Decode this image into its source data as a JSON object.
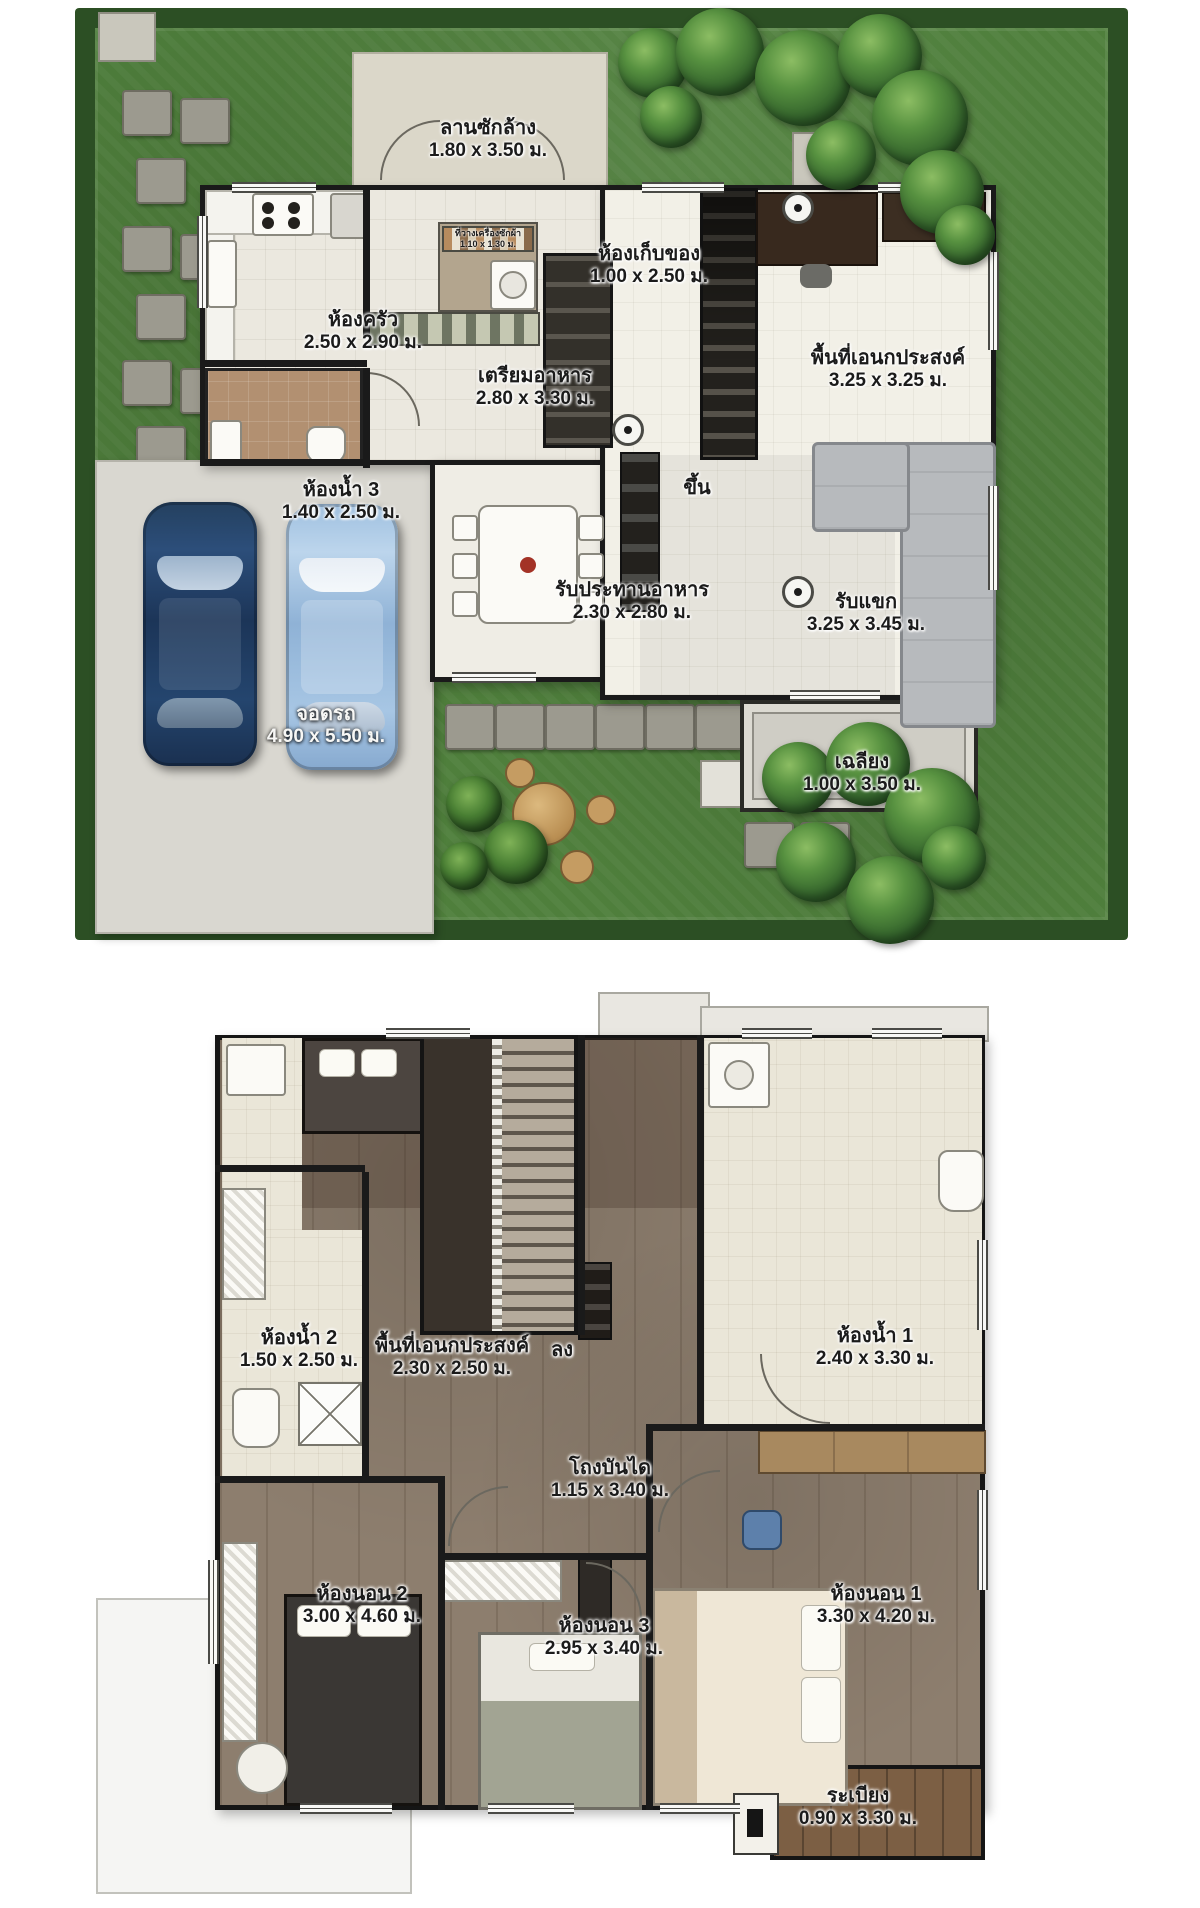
{
  "colors": {
    "grass": "#4f7f3c",
    "hedge": "#2c4f24",
    "floor_cream": "#ebe8df",
    "garage_concrete": "#d9d7d0",
    "wood_floor": "#8d7e6e",
    "balcony_wood": "#7c5f44",
    "bathroom_tile": "#b29071",
    "car_dark_blue": "#2c4e7a",
    "car_light_blue": "#9fc0e0",
    "wall": "#1a1a1a"
  },
  "floor1": {
    "wash_yard": {
      "name": "ลานซักล้าง",
      "dims": "1.80 x 3.50 ม."
    },
    "kitchen": {
      "name": "ห้องครัว",
      "dims": "2.50 x 2.90 ม."
    },
    "laundry": {
      "name": "ที่วางเครื่องซักผ้า",
      "dims": "1.10 x 1.30 ม."
    },
    "storage": {
      "name": "ห้องเก็บของ",
      "dims": "1.00 x 2.50 ม."
    },
    "multipurpose": {
      "name": "พื้นที่เอนกประสงค์",
      "dims": "3.25 x 3.25 ม."
    },
    "food_prep": {
      "name": "เตรียมอาหาร",
      "dims": "2.80 x 3.30 ม."
    },
    "bathroom3": {
      "name": "ห้องน้ำ 3",
      "dims": "1.40 x 2.50 ม."
    },
    "stairs_up": {
      "name": "ขึ้น"
    },
    "dining": {
      "name": "รับประทานอาหาร",
      "dims": "2.30 x 2.80 ม."
    },
    "living": {
      "name": "รับแขก",
      "dims": "3.25 x 3.45 ม."
    },
    "parking": {
      "name": "จอดรถ",
      "dims": "4.90 x 5.50 ม."
    },
    "porch": {
      "name": "เฉลียง",
      "dims": "1.00 x 3.50 ม."
    }
  },
  "floor2": {
    "bathroom2": {
      "name": "ห้องน้ำ 2",
      "dims": "1.50 x 2.50 ม."
    },
    "multipurpose": {
      "name": "พื้นที่เอนกประสงค์",
      "dims": "2.30 x 2.50 ม."
    },
    "stairs_down": {
      "name": "ลง"
    },
    "bathroom1": {
      "name": "ห้องน้ำ 1",
      "dims": "2.40 x 3.30 ม."
    },
    "stair_hall": {
      "name": "โถงบันได",
      "dims": "1.15 x 3.40 ม."
    },
    "bedroom2": {
      "name": "ห้องนอน 2",
      "dims": "3.00 x 4.60 ม."
    },
    "bedroom3": {
      "name": "ห้องนอน 3",
      "dims": "2.95 x 3.40 ม."
    },
    "bedroom1": {
      "name": "ห้องนอน 1",
      "dims": "3.30 x 4.20 ม."
    },
    "balcony": {
      "name": "ระเบียง",
      "dims": "0.90 x 3.30 ม."
    }
  }
}
